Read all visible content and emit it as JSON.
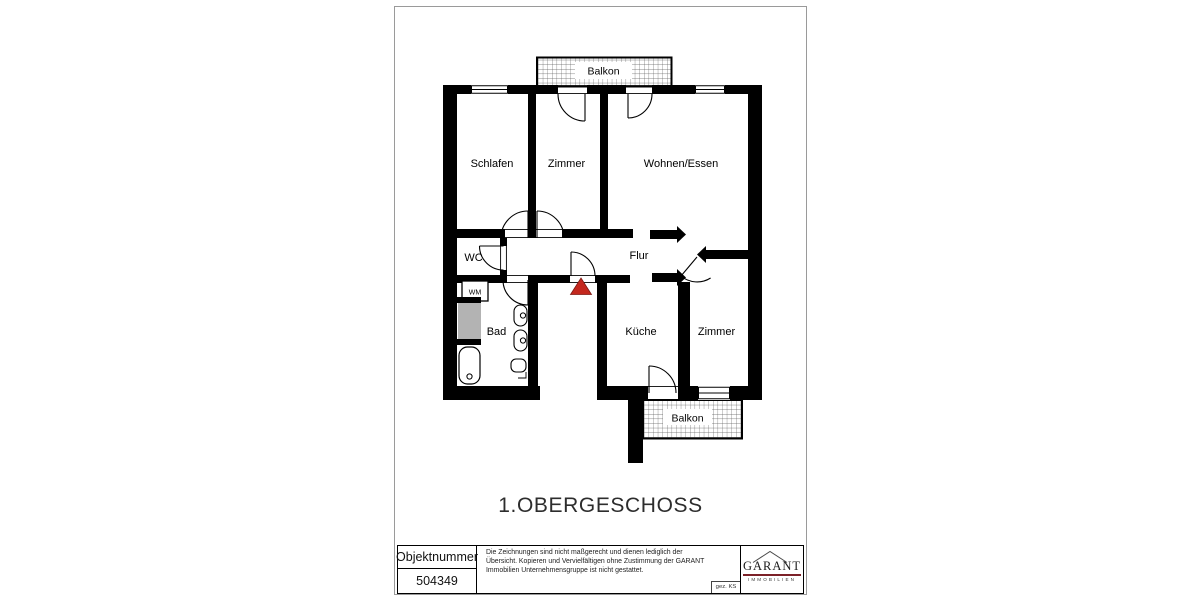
{
  "page": {
    "title": "1.OBERGESCHOSS"
  },
  "plan": {
    "rooms": {
      "balkon_top": "Balkon",
      "schlafen": "Schlafen",
      "zimmer_top": "Zimmer",
      "wohnen": "Wohnen/Essen",
      "wc": "WC",
      "flur": "Flur",
      "bad": "Bad",
      "kueche": "Küche",
      "zimmer_bottom": "Zimmer",
      "balkon_bottom": "Balkon"
    },
    "fixtures": {
      "wm": "WM"
    },
    "entrance_marker_color": "#c4281e"
  },
  "footer": {
    "object_number_label": "Objektnummer",
    "object_number_value": "504349",
    "disclaimer": "Die Zeichnungen sind nicht maßgerecht und dienen lediglich der Übersicht. Kopieren und Vervielfältigen ohne Zustimmung der GARANT Immobilien Unternehmensgruppe ist nicht gestattet.",
    "drawn_by": "gez. KS",
    "logo": {
      "name": "GARANT",
      "subtitle": "IMMOBILIEN",
      "underline_color": "#7c2128"
    }
  }
}
